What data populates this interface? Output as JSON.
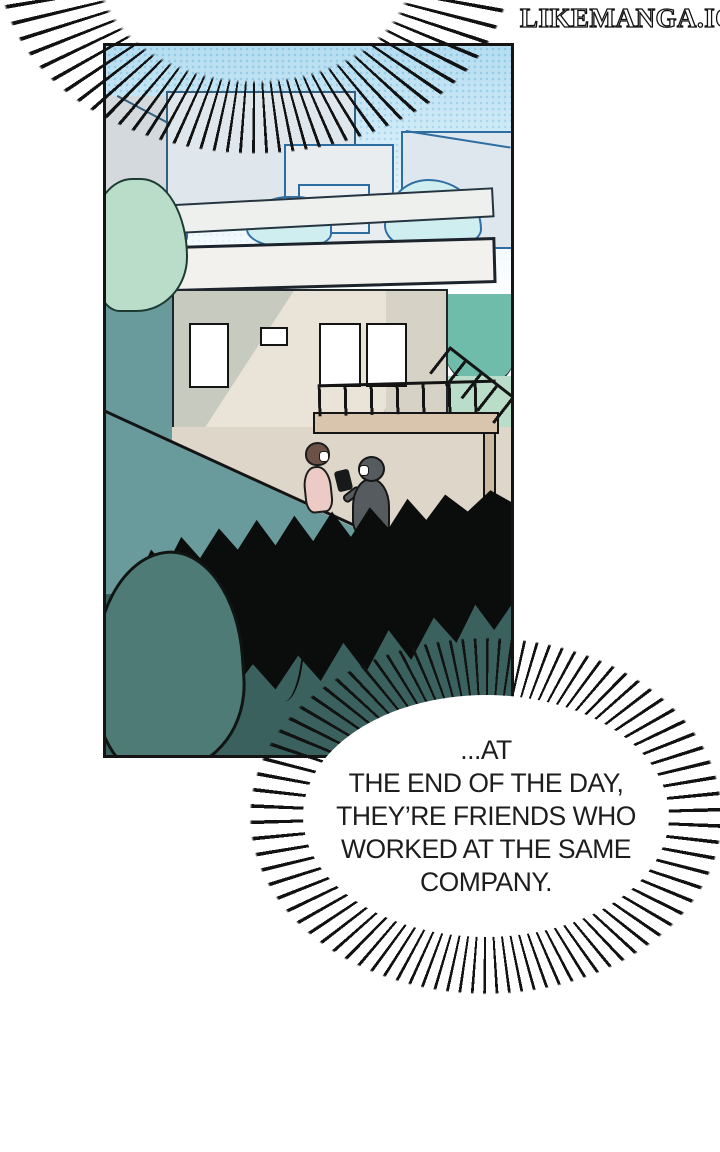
{
  "watermark": {
    "text": "LIKEMANGA.IO"
  },
  "bubbles": {
    "top": {
      "line1": "RELATIONSHIP IS",
      "line2": "COMPLICATED..."
    },
    "bottom": {
      "line1": "...AT",
      "line2": "THE END OF THE DAY,",
      "line3": "THEY’RE FRIENDS WHO",
      "line4": "WORKED AT THE SAME",
      "line5": "COMPANY."
    }
  },
  "panel": {
    "description": "Hillside house with rooftop terrace; two masked people walking down a slope between teal bushes"
  },
  "colors": {
    "page_background": "#ffffff",
    "panel_border": "#141414",
    "sky_blue": "#b5ddf0",
    "building_outline": "#2e6da0",
    "wall_gray": "#c7cabf",
    "slope_beige": "#ddd6c9",
    "mid_teal": "#6a9b9c",
    "tree_teal": "#6fbcab",
    "dark_bush_teal": "#3a615d",
    "silhouette_black": "#0b0d0c",
    "balcony_tan": "#d9c4ad",
    "text": "#1d1d1d"
  }
}
